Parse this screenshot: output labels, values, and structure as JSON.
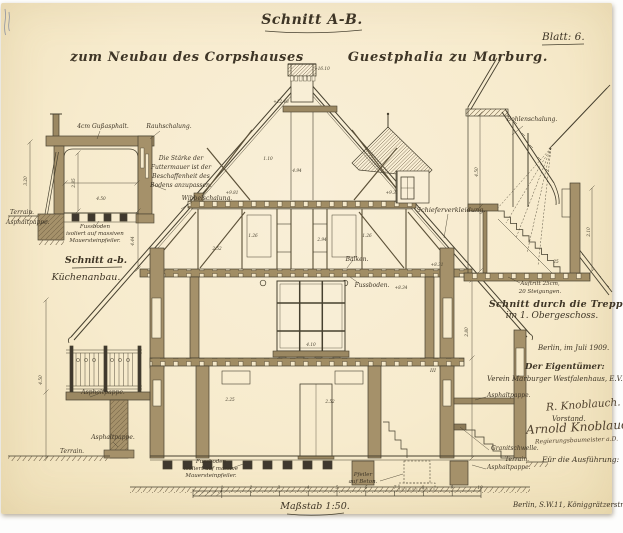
{
  "sheet": {
    "title": "Schnitt A-B.",
    "subtitle_left": "zum Neubau des Corpshauses",
    "subtitle_right": "Guestphalia zu Marburg.",
    "sheet_no": "Blatt: 6.",
    "scale_label": "Maßstab 1:50."
  },
  "kitchen_section": {
    "caption_line1": "Schnitt a-b.",
    "caption_line2": "Küchenanbau.",
    "label_gussasphalt": "4cm Gußasphalt.",
    "label_schalung": "Rauhschalung.",
    "note_line1": "Die Stärke der",
    "note_line2": "Futtermauer ist der",
    "note_line3": "Beschaffenheit des",
    "note_line4": "Bodens anzupassen.",
    "label_terrain": "Terrain.",
    "label_asphaltpappe": "Asphaltpappe.",
    "floor_note_line1": "Fussboden",
    "floor_note_line2": "isoliert auf massiven",
    "floor_note_line3": "Mauersteinpfeiler."
  },
  "main_section": {
    "label_wibbelschalung": "Wibbelschalung.",
    "label_schieferverkleidung": "Schieferverkleidung.",
    "label_balken": "Balken.",
    "label_fussboden": "Fussboden.",
    "label_asphaltpappe_upper_left": "Asphaltpappe.",
    "label_asphaltpappe_lower_left": "Asphaltpappe.",
    "label_terrain_left": "Terrain.",
    "floor_note_line1": "Fussboden",
    "floor_note_line2": "isoliert auf massive",
    "floor_note_line3": "Mauersteinpfeiler.",
    "label_pfeiler_line1": "Pfeiler",
    "label_pfeiler_line2": "auf Beton.",
    "label_granitschwelle": "Granitschwelle.",
    "label_asphaltpappe_upper_right": "Asphaltpappe.",
    "label_terrain_right": "Terrain.",
    "label_asphaltpappe_lower_right": "Asphaltpappe."
  },
  "stair_section": {
    "caption_line1": "Schnitt durch die Treppe",
    "caption_line2": "im 1. Obergeschoss.",
    "label_bohlenschalung": "Bohlenschalung.",
    "label_auftritt_line1": "Auftritt 25cm,",
    "label_auftritt_line2": "20 Steigungen."
  },
  "title_block": {
    "date": "Berlin, im Juli 1909.",
    "owner_heading": "Der Eigentümer:",
    "owner_name": "Verein Marburger Westfalenhaus, E.V.",
    "signature_1": "R. Knoblauch.",
    "signature_1_role": "Vorstand.",
    "signature_2": "Arnold Knoblauch",
    "signature_2_role": "Regierungsbaumeister a.D.",
    "execution_heading": "Für die Ausführung:",
    "address": "Berlin, S.W.11, Königgrätzerstr. 104."
  },
  "dims": [
    {
      "t": "+16.10",
      "x": 322,
      "y": 70
    },
    {
      "t": "+12.48",
      "x": 281,
      "y": 103
    },
    {
      "t": "4.94",
      "x": 297,
      "y": 172
    },
    {
      "t": "1.10",
      "x": 268,
      "y": 160
    },
    {
      "t": "+9.81",
      "x": 232,
      "y": 194
    },
    {
      "t": "+9.31",
      "x": 392,
      "y": 194
    },
    {
      "t": "2.52",
      "x": 217,
      "y": 250
    },
    {
      "t": "1.26",
      "x": 253,
      "y": 237
    },
    {
      "t": "2.94",
      "x": 322,
      "y": 241
    },
    {
      "t": "1.26",
      "x": 367,
      "y": 237
    },
    {
      "t": "+8.34",
      "x": 401,
      "y": 289
    },
    {
      "t": "+8.31",
      "x": 437,
      "y": 266
    },
    {
      "t": "4.44",
      "x": 134,
      "y": 241,
      "r": -90
    },
    {
      "t": "4.50",
      "x": 42,
      "y": 380,
      "r": -90
    },
    {
      "t": "4.10",
      "x": 311,
      "y": 346
    },
    {
      "t": "2.25",
      "x": 230,
      "y": 401
    },
    {
      "t": "2.52",
      "x": 330,
      "y": 403
    },
    {
      "t": "2.80",
      "x": 468,
      "y": 332,
      "r": -90
    },
    {
      "t": "4.50",
      "x": 478,
      "y": 172,
      "r": -90
    },
    {
      "t": "2.10",
      "x": 590,
      "y": 232,
      "r": -90
    },
    {
      "t": "25",
      "x": 556,
      "y": 263
    },
    {
      "t": "2.85",
      "x": 75,
      "y": 183,
      "r": -90
    },
    {
      "t": "3.20",
      "x": 27,
      "y": 181,
      "r": -90
    },
    {
      "t": "4.50",
      "x": 101,
      "y": 200
    },
    {
      "t": "III",
      "x": 433,
      "y": 372,
      "s": 5
    },
    {
      "t": "1",
      "x": 222,
      "y": 489
    },
    {
      "t": "2",
      "x": 251,
      "y": 489
    },
    {
      "t": "3",
      "x": 279,
      "y": 489
    },
    {
      "t": "4",
      "x": 308,
      "y": 489
    },
    {
      "t": "5",
      "x": 337,
      "y": 489
    },
    {
      "t": "6",
      "x": 366,
      "y": 489
    },
    {
      "t": "7",
      "x": 395,
      "y": 489
    },
    {
      "t": "8",
      "x": 423,
      "y": 489
    },
    {
      "t": "9",
      "x": 452,
      "y": 489
    },
    {
      "t": "10",
      "x": 480,
      "y": 489
    }
  ]
}
